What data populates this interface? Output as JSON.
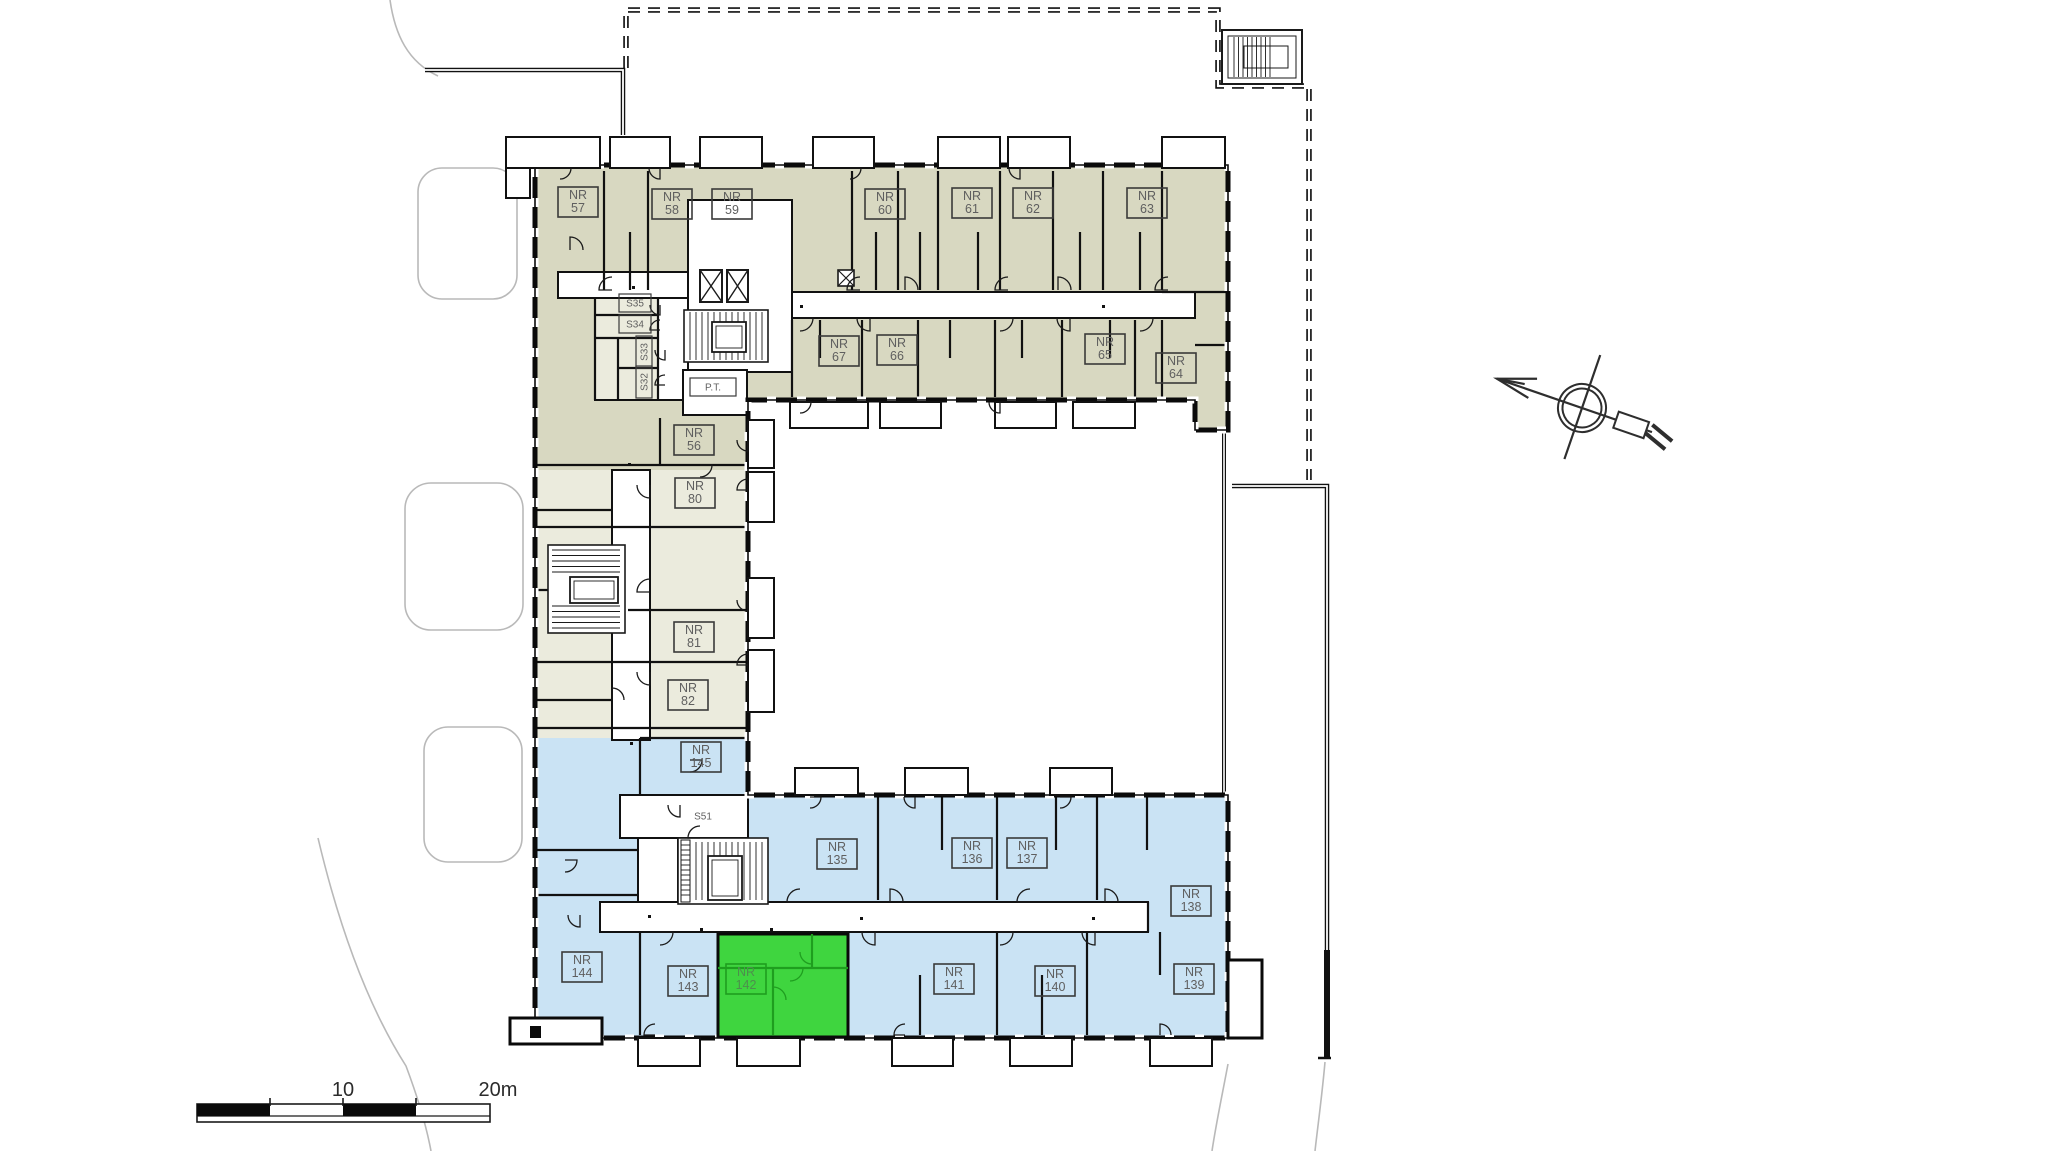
{
  "plan": {
    "highlighted_unit_number": "142",
    "units": [
      {
        "prefix": "NR",
        "number": "57",
        "x": 578,
        "y": 202
      },
      {
        "prefix": "NR",
        "number": "58",
        "x": 672,
        "y": 204
      },
      {
        "prefix": "NR",
        "number": "59",
        "x": 732,
        "y": 204
      },
      {
        "prefix": "NR",
        "number": "60",
        "x": 885,
        "y": 204
      },
      {
        "prefix": "NR",
        "number": "61",
        "x": 972,
        "y": 203
      },
      {
        "prefix": "NR",
        "number": "62",
        "x": 1033,
        "y": 203
      },
      {
        "prefix": "NR",
        "number": "63",
        "x": 1147,
        "y": 203
      },
      {
        "prefix": "NR",
        "number": "67",
        "x": 839,
        "y": 351
      },
      {
        "prefix": "NR",
        "number": "66",
        "x": 897,
        "y": 350
      },
      {
        "prefix": "NR",
        "number": "65",
        "x": 1105,
        "y": 349
      },
      {
        "prefix": "NR",
        "number": "64",
        "x": 1176,
        "y": 368
      },
      {
        "prefix": "NR",
        "number": "56",
        "x": 694,
        "y": 440
      },
      {
        "prefix": "NR",
        "number": "80",
        "x": 695,
        "y": 493
      },
      {
        "prefix": "NR",
        "number": "81",
        "x": 694,
        "y": 637
      },
      {
        "prefix": "NR",
        "number": "82",
        "x": 688,
        "y": 695
      },
      {
        "prefix": "NR",
        "number": "145",
        "x": 701,
        "y": 757
      },
      {
        "prefix": "NR",
        "number": "135",
        "x": 837,
        "y": 854
      },
      {
        "prefix": "NR",
        "number": "136",
        "x": 972,
        "y": 853
      },
      {
        "prefix": "NR",
        "number": "137",
        "x": 1027,
        "y": 853
      },
      {
        "prefix": "NR",
        "number": "138",
        "x": 1191,
        "y": 901
      },
      {
        "prefix": "NR",
        "number": "144",
        "x": 582,
        "y": 967
      },
      {
        "prefix": "NR",
        "number": "143",
        "x": 688,
        "y": 981
      },
      {
        "prefix": "NR",
        "number": "142",
        "x": 746,
        "y": 979,
        "highlighted": true
      },
      {
        "prefix": "NR",
        "number": "141",
        "x": 954,
        "y": 979
      },
      {
        "prefix": "NR",
        "number": "140",
        "x": 1055,
        "y": 981
      },
      {
        "prefix": "NR",
        "number": "139",
        "x": 1194,
        "y": 979
      }
    ],
    "service_rooms": [
      {
        "text": "S35",
        "x": 635,
        "y": 303,
        "rotated": false,
        "boxed": true
      },
      {
        "text": "S34",
        "x": 635,
        "y": 324,
        "rotated": false,
        "boxed": true
      },
      {
        "text": "S33",
        "x": 644,
        "y": 352,
        "rotated": true,
        "boxed": true
      },
      {
        "text": "S32",
        "x": 644,
        "y": 382,
        "rotated": true,
        "boxed": true
      },
      {
        "text": "P.T.",
        "x": 713,
        "y": 387,
        "rotated": false,
        "boxed": true,
        "wide": true
      },
      {
        "text": "S51",
        "x": 703,
        "y": 816,
        "rotated": false,
        "boxed": false
      }
    ],
    "scale_bar": {
      "mid": "10",
      "end": "20m"
    },
    "colors": {
      "wing_top": "#d8d8c1",
      "wing_middle": "#ebebdd",
      "wing_bottom": "#cae3f4",
      "highlight_fill": "#3fd53f",
      "highlight_wall": "#1f9e1f",
      "highlight_text": "#4d8f4d",
      "wall": "#0a0a0a",
      "label_text": "#5f5f5f",
      "label_border": "#3a3a3a",
      "site_line": "#b9b9b9",
      "corridor": "#ffffff"
    }
  }
}
